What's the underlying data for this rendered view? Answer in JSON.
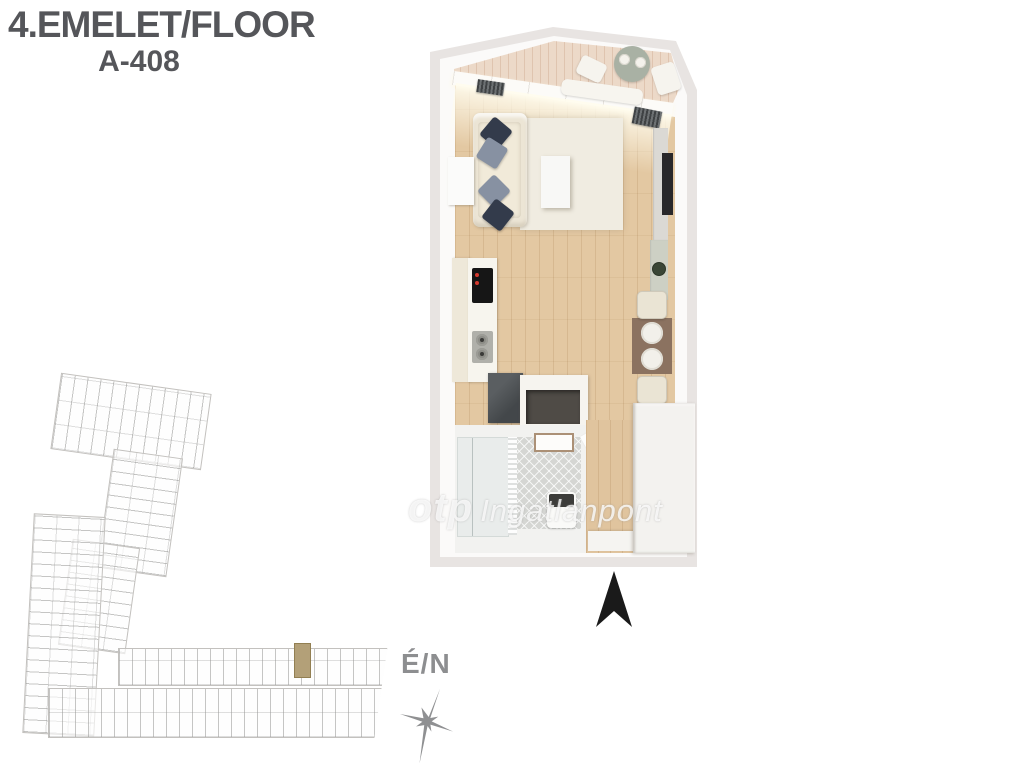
{
  "header": {
    "floor_label": "4.EMELET/FLOOR",
    "unit_label": "A-408",
    "text_color": "#55565a"
  },
  "watermark": {
    "brand": "otp",
    "suffix": "Ingatlanpont"
  },
  "compass": {
    "label": "É/N",
    "color": "#8d8e90"
  },
  "north_arrow": {
    "color": "#1a1a1a"
  },
  "apartment_plan": {
    "type": "3d-top-down-floor-plan-render",
    "rooms": [
      "balcony",
      "living-room",
      "kitchen",
      "dining-area",
      "bathroom",
      "entry-hall"
    ],
    "furniture": [
      "round-table",
      "balcony-chairs",
      "lounger",
      "sofa",
      "pillows",
      "rug",
      "coffee-table",
      "tv",
      "sideboard",
      "kitchen-counter",
      "cooktop",
      "sink",
      "appliance-box",
      "niche-cabinet",
      "plant",
      "dining-table",
      "plates",
      "dining-chairs",
      "shower",
      "towel-rail",
      "toilet",
      "vanity",
      "door",
      "wardrobe",
      "entry-mat"
    ],
    "colors": {
      "plan_base": "#e8e4e2",
      "walls": "#fbfaf9",
      "balcony_wood": "#ecd9c8",
      "floor_wood": "#e3c8a2",
      "rug": "#f0ece1",
      "sofa": "#ece5d5",
      "pillow_navy": "#333b4b",
      "pillow_slate": "#8791a2",
      "tv": "#29282a",
      "cooktop": "#161616",
      "cooktop_indicator": "#d43a2e",
      "appliance": "#43474a",
      "dining_mat": "#8b7260",
      "bath_tile": "#d5d6d3",
      "toilet_lid": "#3c3c3a"
    }
  },
  "building_overview": {
    "type": "schematic-floor-outline",
    "line_color": "#c3c1be",
    "highlight_color": "#b3a078",
    "highlighted_unit": "A-408"
  }
}
